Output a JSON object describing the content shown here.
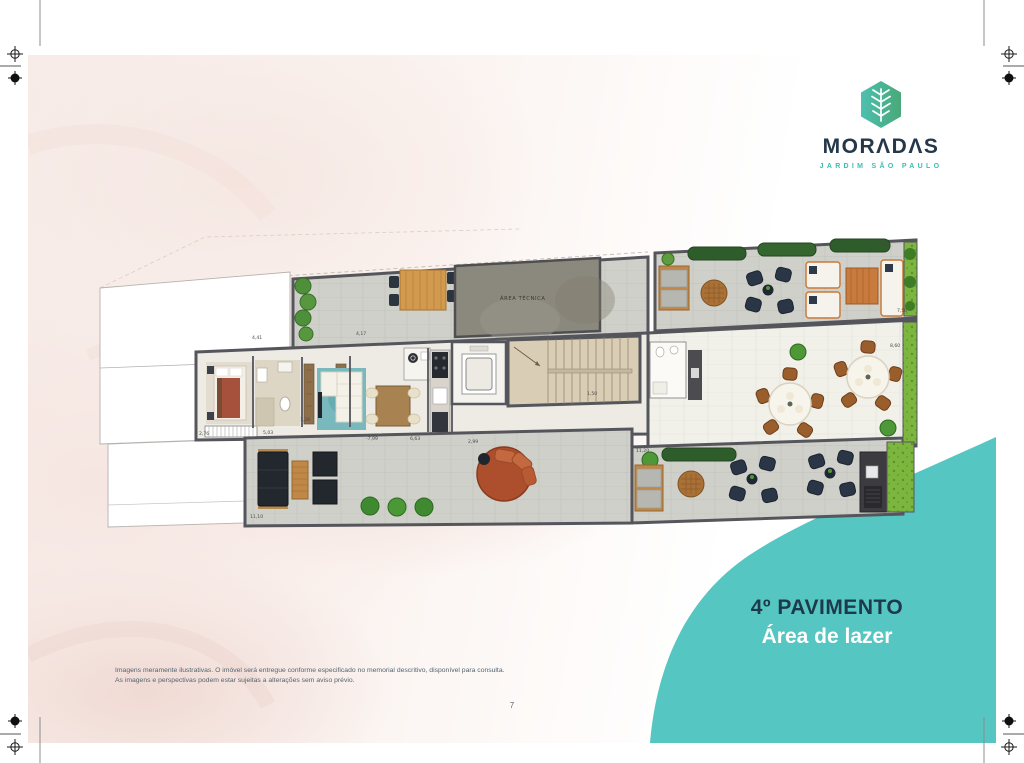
{
  "brand": {
    "name": "MORADAS",
    "wordmark_display": "MORΛDΛS",
    "subtitle": "JARDIM SÃO PAULO",
    "colors": {
      "navy": "#24384a",
      "teal": "#3bbdb4",
      "hex_teal": "#4cc0b0",
      "hex_green": "#49a878"
    }
  },
  "title_block": {
    "line1": "4º PAVIMENTO",
    "line2": "Área de lazer",
    "accent_color": "#55c6c1",
    "line1_color": "#1d3a4d",
    "line2_color": "#ffffff"
  },
  "disclaimer": {
    "line1": "Imagens meramente ilustrativas. O imóvel será entregue conforme especificado no memorial descritivo, disponível para consulta.",
    "line2": "As imagens e perspectivas podem estar sujeitas a alterações sem aviso prévio."
  },
  "page": {
    "number": "7"
  },
  "floor_plan": {
    "area_tecnica": "ÁREA TÉCNICA",
    "dimension_labels": [
      {
        "t": "4,17",
        "x": 356,
        "y": 335
      },
      {
        "t": "4,41",
        "x": 252,
        "y": 339
      },
      {
        "t": "2,76",
        "x": 199,
        "y": 435
      },
      {
        "t": "5,03",
        "x": 263,
        "y": 434
      },
      {
        "t": "1,26",
        "x": 300,
        "y": 421
      },
      {
        "t": "-7,99",
        "x": 366,
        "y": 440
      },
      {
        "t": "6,63",
        "x": 410,
        "y": 440
      },
      {
        "t": "2,99",
        "x": 468,
        "y": 443
      },
      {
        "t": "11,10",
        "x": 250,
        "y": 518
      },
      {
        "t": "11,20",
        "x": 636,
        "y": 452
      },
      {
        "t": "1,50",
        "x": 587,
        "y": 395
      },
      {
        "t": "8,60",
        "x": 890,
        "y": 347
      },
      {
        "t": "7,50",
        "x": 897,
        "y": 312
      },
      {
        "t": "0,60",
        "x": 878,
        "y": 245
      }
    ]
  }
}
